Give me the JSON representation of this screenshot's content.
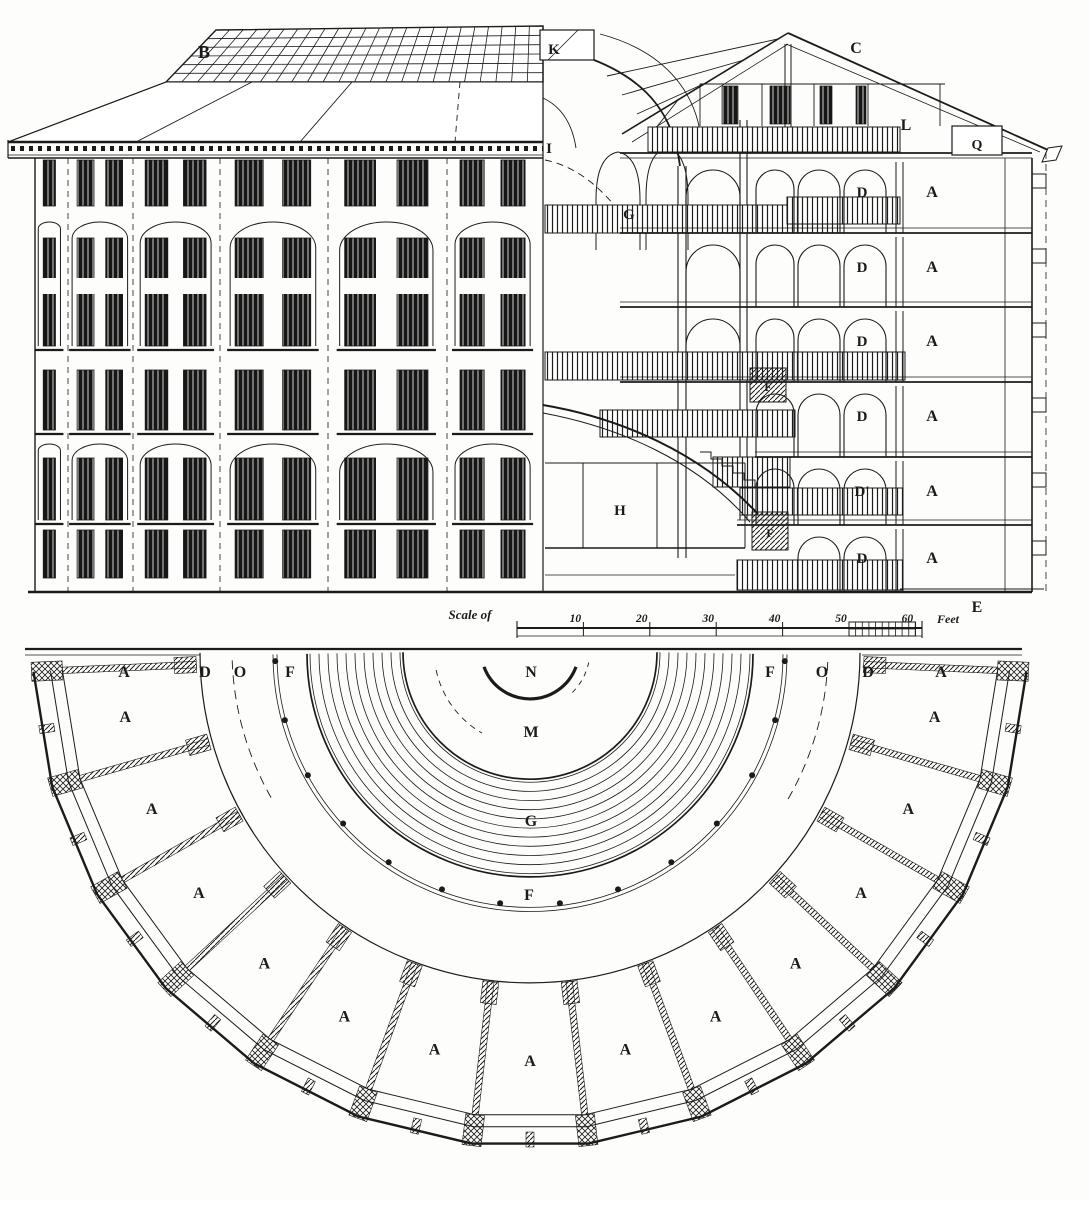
{
  "figure": {
    "title": "Panopticon penitentiary: elevation, section and half plan",
    "ink": "#1b1b1b",
    "paper": "#fdfdfb"
  },
  "scale_bar": {
    "prefix": "Scale of",
    "ticks": [
      "10",
      "20",
      "30",
      "40",
      "50",
      "60"
    ],
    "unit": "Feet"
  },
  "plan": {
    "cells": {
      "count": 13,
      "label": "A"
    }
  },
  "section": {
    "levels": [
      {
        "gallery": "D",
        "cell": "A"
      },
      {
        "gallery": "D",
        "cell": "A"
      },
      {
        "gallery": "D",
        "cell": "A"
      },
      {
        "gallery": "D",
        "cell": "A"
      },
      {
        "gallery": "D'",
        "cell": "A"
      },
      {
        "gallery": "D",
        "cell": "A"
      }
    ]
  },
  "annotations": [
    {
      "id": "roof-b",
      "text": "B",
      "x": 204,
      "y": 52,
      "size": 18
    },
    {
      "id": "lantern-k",
      "text": "K",
      "x": 554,
      "y": 48,
      "size": 15
    },
    {
      "id": "roof-c",
      "text": "C",
      "x": 856,
      "y": 47,
      "size": 16
    },
    {
      "id": "skylight-i",
      "text": "I",
      "x": 549,
      "y": 147,
      "size": 15
    },
    {
      "id": "attic-l",
      "text": "L",
      "x": 906,
      "y": 124,
      "size": 16
    },
    {
      "id": "attic-q",
      "text": "Q",
      "x": 977,
      "y": 143,
      "size": 14
    },
    {
      "id": "well-g",
      "text": "G",
      "x": 629,
      "y": 213,
      "size": 15
    },
    {
      "id": "hall-h",
      "text": "H",
      "x": 620,
      "y": 509,
      "size": 15
    },
    {
      "id": "foundation-e",
      "text": "E",
      "x": 977,
      "y": 606,
      "size": 16
    },
    {
      "id": "stair-f-upper",
      "text": "F",
      "x": 768,
      "y": 385,
      "size": 12
    },
    {
      "id": "stair-f-lower",
      "text": "F",
      "x": 770,
      "y": 531,
      "size": 12
    },
    {
      "id": "plan-a-left",
      "text": "A",
      "x": 124,
      "y": 671,
      "size": 16
    },
    {
      "id": "plan-d-left",
      "text": "D",
      "x": 205,
      "y": 671,
      "size": 16
    },
    {
      "id": "plan-o-left",
      "text": "O",
      "x": 240,
      "y": 671,
      "size": 16
    },
    {
      "id": "plan-f-left",
      "text": "F",
      "x": 290,
      "y": 671,
      "size": 16
    },
    {
      "id": "plan-n",
      "text": "N",
      "x": 531,
      "y": 671,
      "size": 16
    },
    {
      "id": "plan-f-right",
      "text": "F",
      "x": 770,
      "y": 671,
      "size": 16
    },
    {
      "id": "plan-o-right",
      "text": "O",
      "x": 822,
      "y": 671,
      "size": 16
    },
    {
      "id": "plan-d-right",
      "text": "D",
      "x": 868,
      "y": 671,
      "size": 16
    },
    {
      "id": "plan-a-right",
      "text": "A",
      "x": 941,
      "y": 671,
      "size": 16
    },
    {
      "id": "plan-m",
      "text": "M",
      "x": 531,
      "y": 731,
      "size": 16
    },
    {
      "id": "plan-g",
      "text": "G",
      "x": 531,
      "y": 820,
      "size": 16
    },
    {
      "id": "plan-f-center",
      "text": "F",
      "x": 529,
      "y": 894,
      "size": 16
    }
  ]
}
